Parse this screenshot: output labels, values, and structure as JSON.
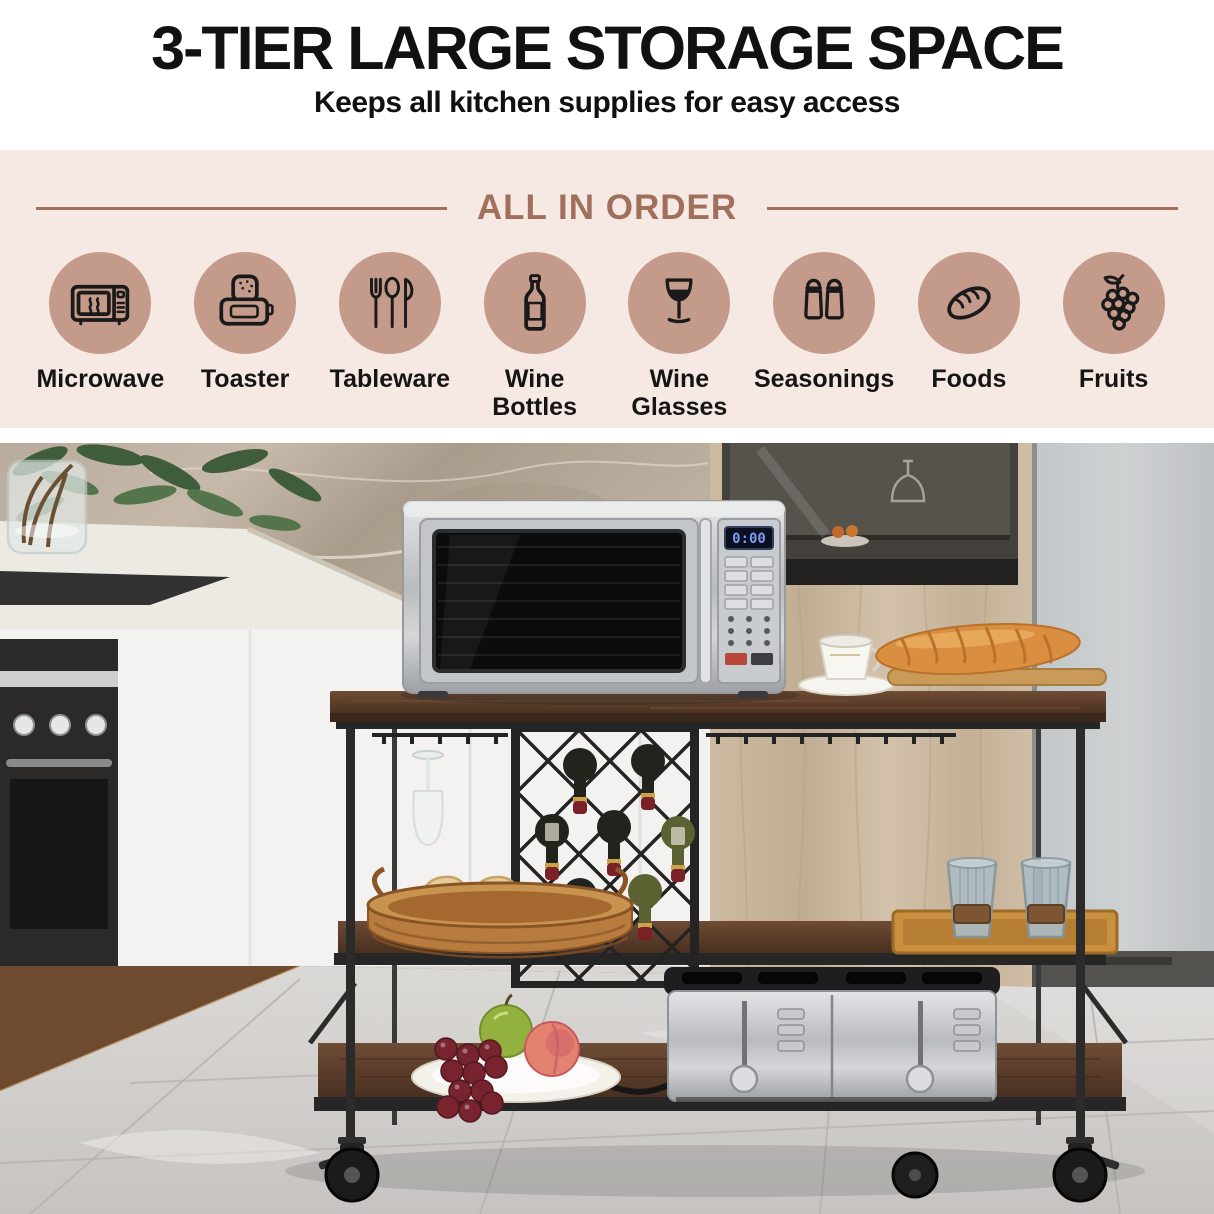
{
  "header": {
    "title": "3-TIER LARGE STORAGE SPACE",
    "subtitle": "Keeps all kitchen supplies for easy access"
  },
  "features": {
    "heading": "ALL IN ORDER",
    "items": [
      {
        "label": "Microwave",
        "icon": "microwave-icon"
      },
      {
        "label": "Toaster",
        "icon": "toaster-icon"
      },
      {
        "label": "Tableware",
        "icon": "tableware-icon"
      },
      {
        "label": "Wine Bottles",
        "icon": "wine-bottles-icon"
      },
      {
        "label": "Wine Glasses",
        "icon": "wine-glasses-icon"
      },
      {
        "label": "Seasonings",
        "icon": "seasonings-icon"
      },
      {
        "label": "Foods",
        "icon": "foods-bread-icon"
      },
      {
        "label": "Fruits",
        "icon": "fruits-grapes-icon"
      }
    ]
  },
  "photo": {
    "microwave_display": "0:00"
  },
  "colors": {
    "section_bg": "#f6e8e2",
    "icon_circle": "#c49a8a",
    "accent_brown": "#a1705c",
    "text": "#1a1a1a"
  }
}
